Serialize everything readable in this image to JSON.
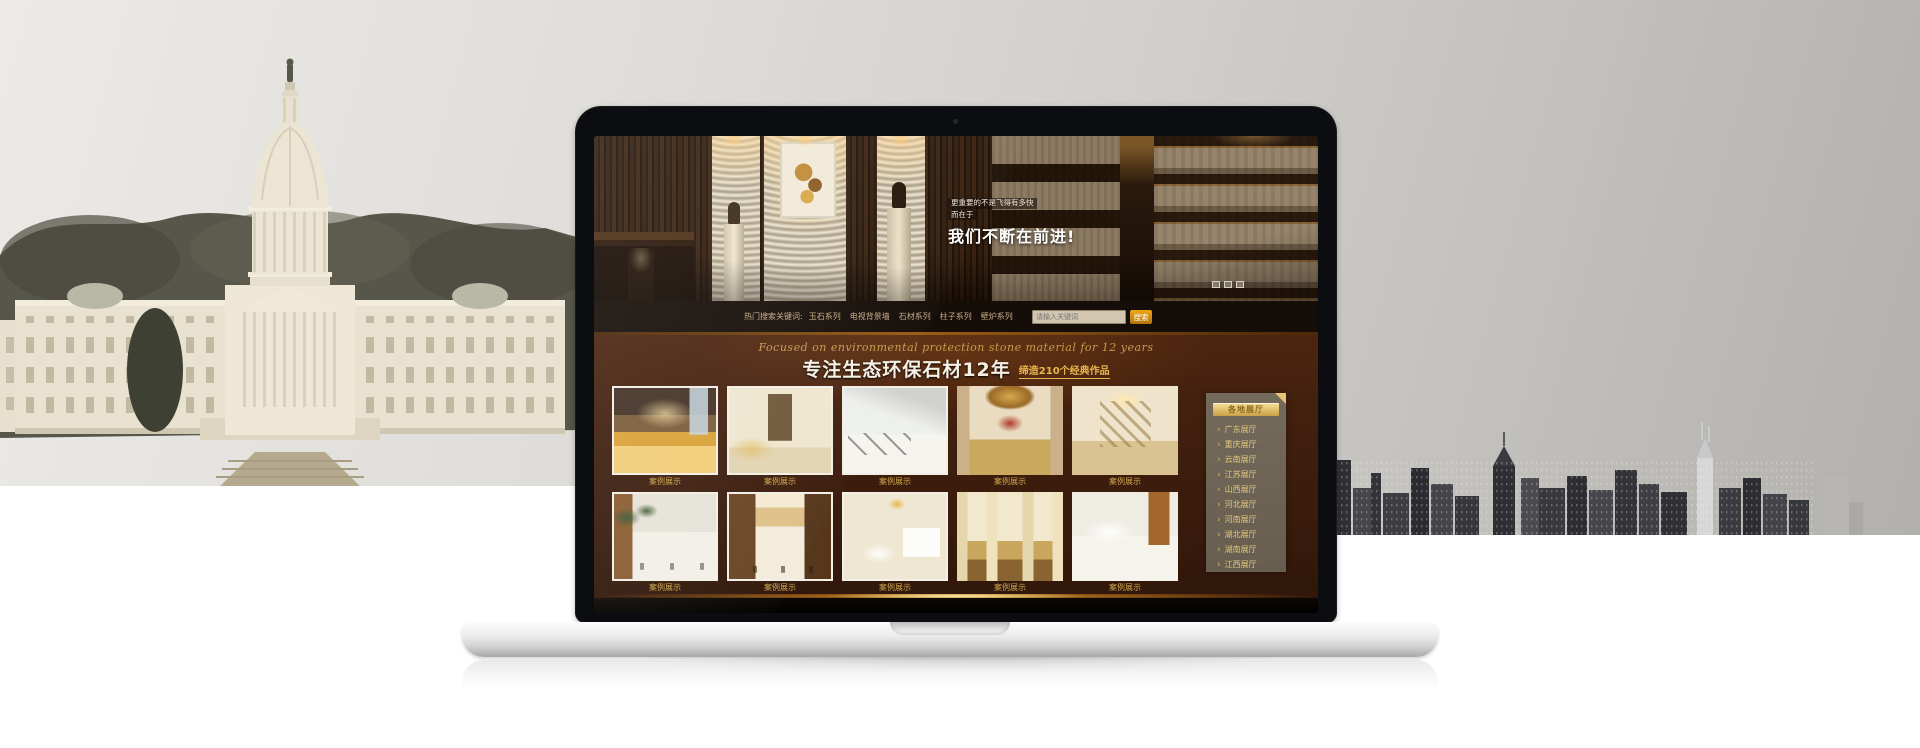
{
  "scene": {
    "left_backdrop": "us-capitol-building-photo",
    "right_backdrop": "city-skyline-photo",
    "device": "silver-laptop-mockup"
  },
  "site": {
    "hero": {
      "tagline_line1": "更重要的不是飞得有多快",
      "tagline_line2": "而在于",
      "headline": "我们不断在前进!",
      "indicators": [
        "slide-1",
        "slide-2",
        "slide-3"
      ]
    },
    "keyword_bar": {
      "label": "热门搜索关键词:",
      "keywords": [
        "玉石系列",
        "电视背景墙",
        "石材系列",
        "柱子系列",
        "壁炉系列"
      ],
      "search_placeholder": "请输入关键词",
      "search_button": "搜索"
    },
    "intro": {
      "script_line": "Focused on environmental protection stone material for 12 years",
      "title": "专注生态环保石材12年",
      "subtitle": "缔造210个经典作品"
    },
    "gallery": {
      "items": [
        {
          "caption": "案例展示",
          "cls": "g1 framed"
        },
        {
          "caption": "案例展示",
          "cls": "g2 framed"
        },
        {
          "caption": "案例展示",
          "cls": "g3 framed"
        },
        {
          "caption": "案例展示",
          "cls": "g4"
        },
        {
          "caption": "案例展示",
          "cls": "g5"
        },
        {
          "caption": "案例展示",
          "cls": "g6 framed"
        },
        {
          "caption": "案例展示",
          "cls": "g7 framed"
        },
        {
          "caption": "案例展示",
          "cls": "g8 framed"
        },
        {
          "caption": "案例展示",
          "cls": "g9"
        },
        {
          "caption": "案例展示",
          "cls": "g10"
        }
      ]
    },
    "sidebar": {
      "header": "各地展厅",
      "items": [
        {
          "label": "广东展厅"
        },
        {
          "label": "重庆展厅"
        },
        {
          "label": "云南展厅"
        },
        {
          "label": "江苏展厅"
        },
        {
          "label": "山西展厅"
        },
        {
          "label": "河北展厅"
        },
        {
          "label": "河南展厅"
        },
        {
          "label": "湖北展厅"
        },
        {
          "label": "湖南展厅"
        },
        {
          "label": "江西展厅"
        }
      ]
    },
    "colors": {
      "accent_gold": "#d9b263",
      "page_brown": "#3f2010",
      "search_button_orange": "#d8910f",
      "panel_taupe": "#6e6456"
    }
  }
}
